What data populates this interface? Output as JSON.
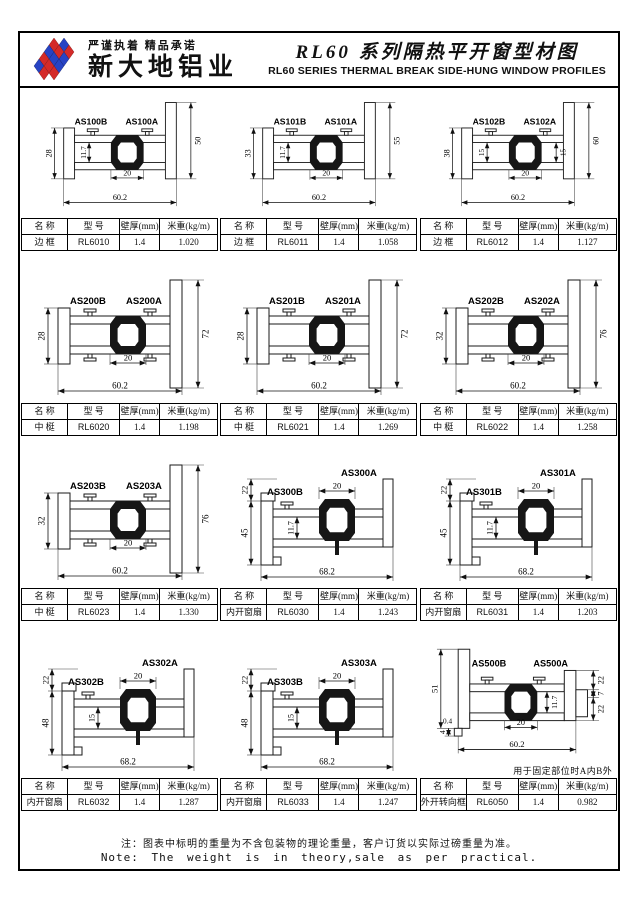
{
  "page": {
    "logo": {
      "slogan": "严谨执着 精品承诺",
      "company": "新大地铝业"
    },
    "title_cn": "RL60 系列隔热平开窗型材图",
    "title_en": "RL60 SERIES THERMAL BREAK SIDE-HUNG WINDOW PROFILES",
    "footer_note_cn": "注：图表中标明的重量为不含包装物的理论重量，客户订货以实际过磅重量为准。",
    "footer_note_en": "Note: The weight is in theory,sale as per practical.",
    "colors": {
      "logo_red": "#d42a28",
      "logo_blue": "#2743c4",
      "ink": "#111111"
    }
  },
  "table_headers": {
    "name": "名 称",
    "model": "型 号",
    "thickness": "壁厚(mm)",
    "weight": "米重(kg/m)"
  },
  "cells": [
    {
      "type": "frame",
      "label_b": "AS100B",
      "label_a": "AS100A",
      "dims": {
        "left": "28",
        "right": "50",
        "inner_v": "11.7",
        "inner_h": "20",
        "bottom": "60.2"
      },
      "table": {
        "name": "边 框",
        "model": "RL6010",
        "thickness": "1.4",
        "weight": "1.020"
      }
    },
    {
      "type": "frame",
      "label_b": "AS101B",
      "label_a": "AS101A",
      "dims": {
        "left": "33",
        "right": "55",
        "inner_v": "11.7",
        "inner_h": "20",
        "bottom": "60.2"
      },
      "table": {
        "name": "边 框",
        "model": "RL6011",
        "thickness": "1.4",
        "weight": "1.058"
      }
    },
    {
      "type": "frame",
      "label_b": "AS102B",
      "label_a": "AS102A",
      "dims": {
        "left": "38",
        "right": "60",
        "inner_v": "15",
        "inner_v2": "15",
        "inner_h": "20",
        "bottom": "60.2"
      },
      "table": {
        "name": "边 框",
        "model": "RL6012",
        "thickness": "1.4",
        "weight": "1.127"
      }
    },
    {
      "type": "mullion",
      "label_b": "AS200B",
      "label_a": "AS200A",
      "dims": {
        "left": "28",
        "right": "72",
        "inner_h": "20",
        "bottom": "60.2"
      },
      "table": {
        "name": "中 梃",
        "model": "RL6020",
        "thickness": "1.4",
        "weight": "1.198"
      }
    },
    {
      "type": "mullion",
      "label_b": "AS201B",
      "label_a": "AS201A",
      "dims": {
        "left": "28",
        "right": "72",
        "inner_h": "20",
        "bottom": "60.2"
      },
      "table": {
        "name": "中 梃",
        "model": "RL6021",
        "thickness": "1.4",
        "weight": "1.269"
      }
    },
    {
      "type": "mullion",
      "label_b": "AS202B",
      "label_a": "AS202A",
      "dims": {
        "left": "32",
        "right": "76",
        "inner_h": "20",
        "bottom": "60.2"
      },
      "table": {
        "name": "中 梃",
        "model": "RL6022",
        "thickness": "1.4",
        "weight": "1.258"
      }
    },
    {
      "type": "mullion",
      "label_b": "AS203B",
      "label_a": "AS203A",
      "dims": {
        "left": "32",
        "right": "76",
        "inner_h": "20",
        "bottom": "60.2"
      },
      "table": {
        "name": "中 梃",
        "model": "RL6023",
        "thickness": "1.4",
        "weight": "1.330"
      }
    },
    {
      "type": "sash",
      "label_b": "AS300B",
      "label_a": "AS300A",
      "dims": {
        "top_left": "22",
        "left": "45",
        "inner_v": "11.7",
        "top": "20",
        "bottom": "68.2"
      },
      "table": {
        "name": "内开窗扇",
        "model": "RL6030",
        "thickness": "1.4",
        "weight": "1.243"
      }
    },
    {
      "type": "sash",
      "label_b": "AS301B",
      "label_a": "AS301A",
      "dims": {
        "top_left": "22",
        "left": "45",
        "inner_v": "11.7",
        "top": "20",
        "bottom": "68.2"
      },
      "table": {
        "name": "内开窗扇",
        "model": "RL6031",
        "thickness": "1.4",
        "weight": "1.203"
      }
    },
    {
      "type": "sash",
      "label_b": "AS302B",
      "label_a": "AS302A",
      "dims": {
        "top_left": "22",
        "left": "48",
        "inner_v": "15",
        "top": "20",
        "bottom": "68.2"
      },
      "table": {
        "name": "内开窗扇",
        "model": "RL6032",
        "thickness": "1.4",
        "weight": "1.287"
      }
    },
    {
      "type": "sash",
      "label_b": "AS303B",
      "label_a": "AS303A",
      "dims": {
        "top_left": "22",
        "left": "48",
        "inner_v": "15",
        "top": "20",
        "bottom": "68.2"
      },
      "table": {
        "name": "内开窗扇",
        "model": "RL6033",
        "thickness": "1.4",
        "weight": "1.247"
      }
    },
    {
      "type": "turning",
      "label_b": "AS500B",
      "label_a": "AS500A",
      "note": "用于固定部位时A内B外",
      "dims": {
        "left": "51",
        "left_small": "0.4",
        "bottom_left": "4",
        "right_top": "22",
        "right_mid": "7",
        "right_bot": "22",
        "inner_v": "11.7",
        "inner_h": "20",
        "bottom": "60.2"
      },
      "table": {
        "name": "外开转向框",
        "model": "RL6050",
        "thickness": "1.4",
        "weight": "0.982"
      }
    }
  ]
}
